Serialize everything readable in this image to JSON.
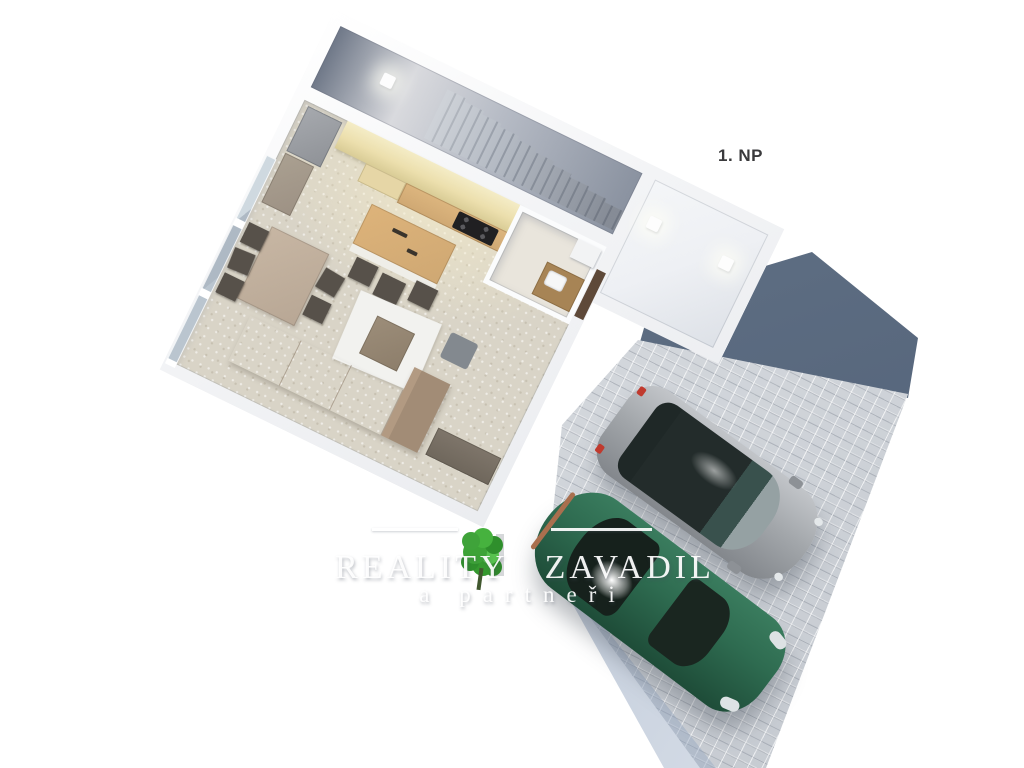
{
  "floor_label": "1. NP",
  "watermark": {
    "brand_left": "REALITY",
    "brand_right": "ZAVADIL",
    "subtitle": "a partneři"
  },
  "colors": {
    "background": "#ffffff",
    "label_text": "#3a3a3c",
    "watermark_text": "rgba(255,255,255,0.93)",
    "wall": "#f3f4f6",
    "corridor_floor_dark": "#6f7888",
    "stairs_tread": "#b5bbc4",
    "hall_floor": "#eef0f4",
    "floor_main": "#d9d4c7",
    "kitchen_wall_tan": "#ecdfad",
    "wood_counter": "#cfa873",
    "cooktop": "#202022",
    "fridge_gray": "#8f9297",
    "dining_table": "#b8a795",
    "chair_dark": "#57514a",
    "rug": "#f2f2ef",
    "coffee_table": "#8d7e6b",
    "sofa": "#a28c76",
    "sideboard": "#6f675c",
    "window_glass": "#bac5cf",
    "bathroom_floor": "#e9e5dc",
    "door_brown": "#5e4939",
    "paver": "#d2d6db",
    "slate_roof": "#5d6d82",
    "shadow_blue": "#93a5bf",
    "car_gray_body": "#a3a7ab",
    "car_glass_dark": "#232c2b",
    "car_green_body": "#2e6b50",
    "taillight_red": "#c03a2e",
    "tree_green": "#3fa33a"
  }
}
